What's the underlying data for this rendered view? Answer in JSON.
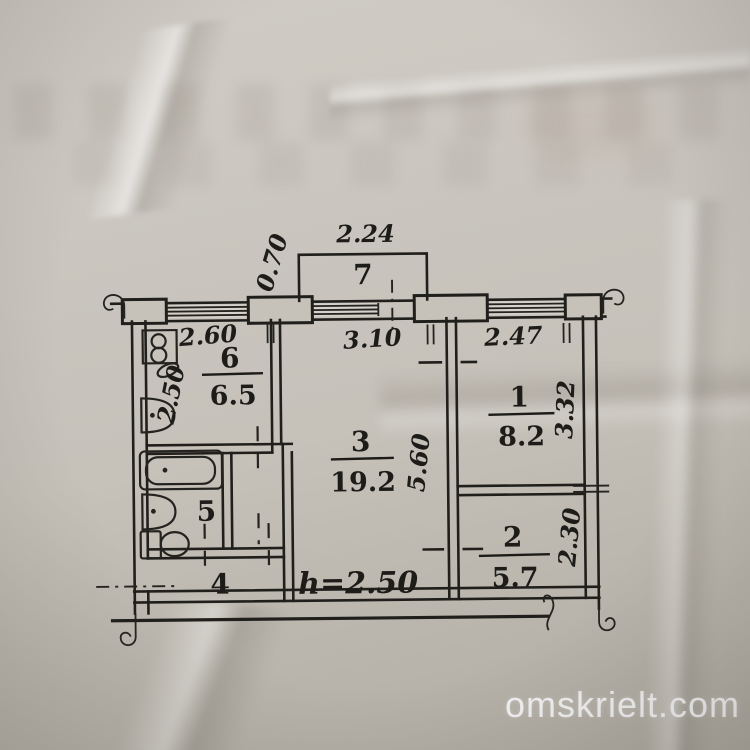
{
  "watermark": {
    "text": "omskrielt.com"
  },
  "plan": {
    "ceiling_height_label": "h=2.50",
    "rooms": [
      {
        "number": "7",
        "area": ""
      },
      {
        "number": "6",
        "area": "6.5"
      },
      {
        "number": "5",
        "area": ""
      },
      {
        "number": "4",
        "area": ""
      },
      {
        "number": "3",
        "area": "19.2"
      },
      {
        "number": "1",
        "area": "8.2"
      },
      {
        "number": "2",
        "area": "5.7"
      }
    ],
    "dimensions": {
      "balcony_width": "2.24",
      "balcony_depth": "0.70",
      "kitchen_width": "2.60",
      "kitchen_depth": "2.50",
      "living_width": "3.10",
      "living_depth": "5.60",
      "room1_width": "2.47",
      "room1_depth": "3.32",
      "room2_depth": "2.30"
    },
    "colors": {
      "ink": "#201f1c",
      "paper": "#c8c4bd"
    }
  }
}
